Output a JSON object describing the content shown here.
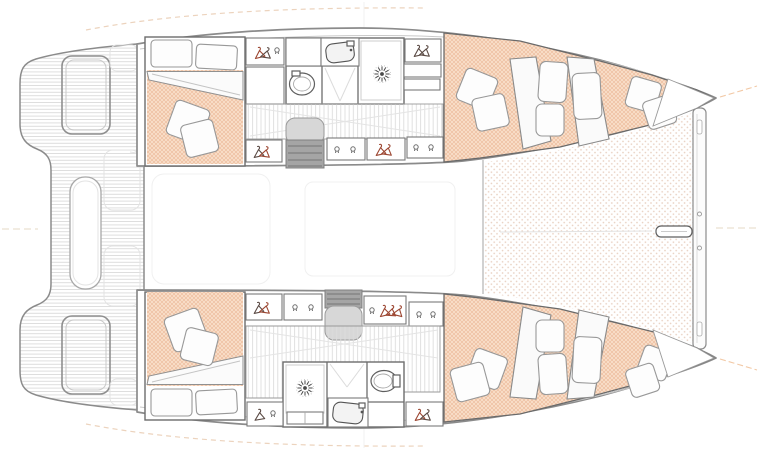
{
  "diagram": {
    "kind": "catamaran-deck-floor-plan",
    "orientation": "bow-right-stern-left",
    "hull_count": 2,
    "cabin_count": 4,
    "bathroom_count": 2
  },
  "legend": {
    "hanger_icon": "hanging wardrobe locker",
    "hook_icon": "locker hook / knob",
    "sunburst_icon": "shower drain",
    "oval_icon": "toilet",
    "basin_icon": "washbasin",
    "dotted_lattice_texture": "mattress upholstery",
    "dot_grid_texture": "bow trampoline netting",
    "striped_floor": "hull corridor sole",
    "planked_floor": "cockpit / transom decking"
  },
  "colors": {
    "background": "#ffffff",
    "hull_outline": "#8b8b8b",
    "wall": "#6d6d6d",
    "mattress_base": "#f9dfc9",
    "mattress_weave": "#e9b28f",
    "trampoline_dot": "#e8cfc0",
    "pillow_fill": "#fdfdfd",
    "pillow_stroke": "#989898",
    "plank_line": "#d6d6d6",
    "stripe_line": "#dcdcdc",
    "steps_light": "#d7d7d7",
    "steps_dark": "#a5a5a5",
    "hanger_dark": "#5a4a44",
    "hanger_red": "#9c4631",
    "guide_dash": "#ecd3bd",
    "bow_dash": "#f2c9a6",
    "centerline_dash": "#e6d9c6"
  }
}
